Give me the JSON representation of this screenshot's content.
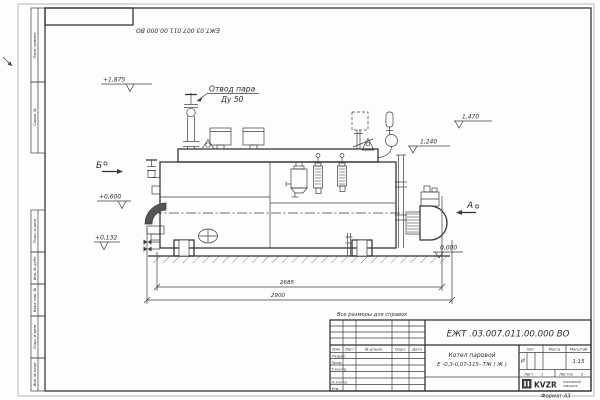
{
  "sheet": {
    "note_reference": "Все размеры для справок",
    "format_label": "Формат А3"
  },
  "stamp": {
    "doc_number": "ЕЖТ.03.007.011.00.000  ВО"
  },
  "frame_labels": {
    "col1": "Перв. примен.",
    "col2": "Справ. №",
    "col3": "Подп. и дата",
    "col4": "Инв. № дубл.",
    "col5": "Взам. инв. №",
    "col6": "Подп. и дата",
    "col7": "Инв. № подл."
  },
  "title_block": {
    "doc_number": "ЕЖТ .03.007.011.00.000  ВО",
    "product_line1": "Котел паровой",
    "product_line2": "Е -0,3-0,07-115- ТЖ ( Ж )",
    "header": {
      "izm": "Изм.",
      "list": "Лист",
      "doc": "№ докум.",
      "podp": "Подп.",
      "data": "Дата"
    },
    "signatures": {
      "razrab": "Разраб.",
      "prov": "Пров.",
      "tkontr": "Т.контр.",
      "nkontr": "Н.контр.",
      "utv": "Утв."
    },
    "lit_label": "Лит.",
    "mass_label": "Масса",
    "scale_label": "Масштаб",
    "lit_value": "И",
    "scale_value": "1:15",
    "sheet_label": "Лист",
    "sheet_value": "1",
    "sheets_label": "Листов",
    "sheets_value": "2",
    "logo": {
      "name": "KVZR",
      "sub1": "КОТЕЛЬНЫЙ",
      "sub2": "ЗАВОД РФ"
    }
  },
  "drawing": {
    "callout_steam_line1": "Отвод пара",
    "callout_steam_line2": "Ду 50",
    "view_b": "Б",
    "view_a": "А",
    "elev_1875": "+1,875",
    "elev_1470": "1,470",
    "elev_1240": "1,240",
    "elev_0600": "+0,600",
    "elev_0132": "+0,132",
    "elev_0000": "0,000",
    "dim_2685": "2685",
    "dim_2900": "2900"
  }
}
